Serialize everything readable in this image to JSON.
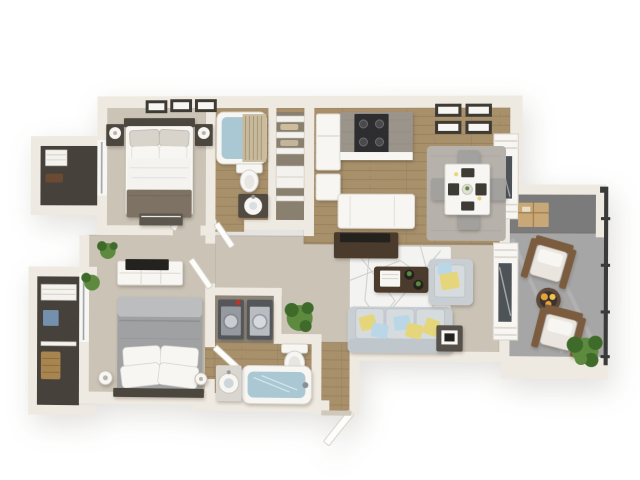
{
  "scene": {
    "title": "3D floor plan rendering of a two-bedroom apartment",
    "style": "bird's-eye 3D architectural render, no text labels"
  },
  "palette": {
    "wall": "#efeae1",
    "wallShade": "#d6cfc2",
    "carpet": "#cac3b6",
    "wood": "#a8906b",
    "woodLine": "#8d7354",
    "balconyFloor": "#a6a6a6",
    "storageFloor": "#7b7b7b",
    "closetFloor": "#46413a",
    "laundryFloor": "#8c8578",
    "white": "#f7f6f3",
    "water": "#a9c8d4",
    "sofa": "#c9ced3",
    "sofaLight": "#d6dbde",
    "rugLiving": "#f3f3f1",
    "rugDining": "#b6b2ab",
    "tableWood": "#4a3b2d",
    "darkTv": "#23221f",
    "bedBlanket": "#7d7264",
    "bedGray": "#a0a1a3",
    "bedGrayLight": "#bcbdbf",
    "headboard": "#4b463e",
    "pillowYellow": "#e5d67b",
    "pillowBlue": "#b9d7e6",
    "plant": "#5d8a3e",
    "plantDark": "#3f6b2a",
    "chairBrown": "#7b5c3e",
    "cushion": "#eae6df",
    "fire": "#e8a23c",
    "railing": "#3a3a3a",
    "boxTan": "#c9a877",
    "basket": "#a8854e",
    "blueBox": "#7390ac",
    "appliance": "#54565a",
    "applianceFront": "#9599a0",
    "red": "#c23227",
    "granite": "#9b948a",
    "stove": "#2e2e30",
    "chairGray": "#a2a19e",
    "frame": "#3e3a34",
    "glass": "#4d5356"
  },
  "rooms": [
    {
      "id": "master-bedroom"
    },
    {
      "id": "master-closet"
    },
    {
      "id": "bathroom-1"
    },
    {
      "id": "linen-closet"
    },
    {
      "id": "kitchen"
    },
    {
      "id": "dining-area"
    },
    {
      "id": "living-room"
    },
    {
      "id": "hallway"
    },
    {
      "id": "bedroom-2"
    },
    {
      "id": "bedroom-2-closet"
    },
    {
      "id": "laundry-closet"
    },
    {
      "id": "bathroom-2"
    },
    {
      "id": "entry"
    },
    {
      "id": "balcony"
    },
    {
      "id": "balcony-storage"
    }
  ],
  "furniture": [
    "double-bed-master",
    "nightstands-with-lamps",
    "wall-art-frames",
    "bedroom1-dresser",
    "bathtub-1",
    "toilet-1",
    "vanity-sink-1",
    "shower-curtain",
    "linen-shelves",
    "refrigerator",
    "kitchen-counter-granite",
    "stove",
    "kitchen-island",
    "tv-console",
    "dining-table",
    "dining-chairs",
    "dining-rug",
    "window-shutters",
    "sofa-with-pillows",
    "armchair",
    "coffee-table",
    "side-table",
    "living-rug",
    "sliding-door-blinds",
    "double-bed-2",
    "tv-dresser-2",
    "potted-plants",
    "closet-shelves",
    "storage-basket",
    "storage-box",
    "washer",
    "dryer",
    "toilet-2",
    "bathtub-2",
    "pedestal-sink",
    "entry-door",
    "patio-chairs",
    "fire-pit-table",
    "balcony-railing"
  ]
}
